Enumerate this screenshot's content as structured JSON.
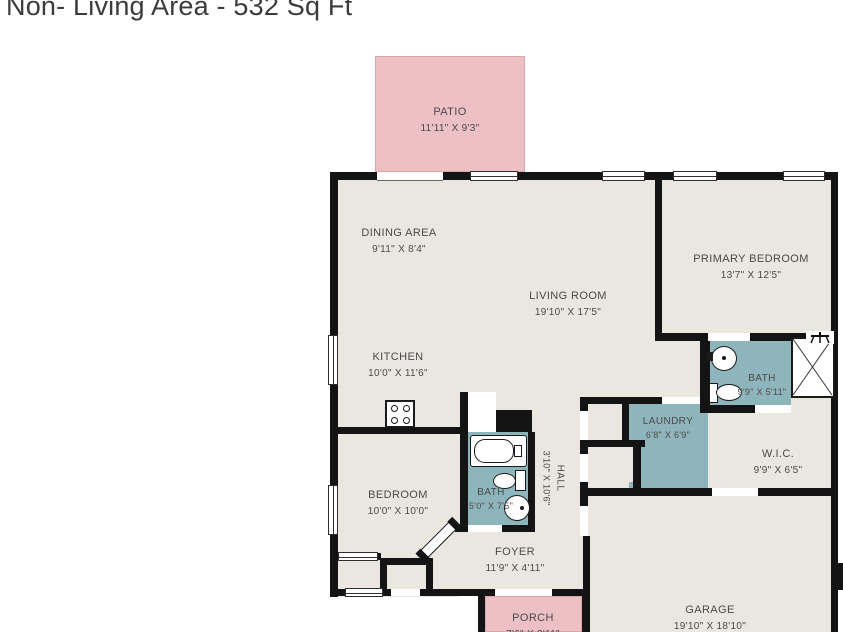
{
  "title": "Non- Living Area - 532 Sq Ft",
  "rooms": {
    "patio": {
      "name": "PATIO",
      "dims": "11'11\" X 9'3\""
    },
    "dining": {
      "name": "DINING AREA",
      "dims": "9'11\" X 8'4\""
    },
    "living": {
      "name": "LIVING ROOM",
      "dims": "19'10\" X 17'5\""
    },
    "primary_bedroom": {
      "name": "PRIMARY BEDROOM",
      "dims": "13'7\" X 12'5\""
    },
    "kitchen": {
      "name": "KITCHEN",
      "dims": "10'0\" X 11'6\""
    },
    "bath_main": {
      "name": "BATH",
      "dims": "5'0\" X 7'5\""
    },
    "hall": {
      "name": "HALL",
      "dims": "3'10\" X 10'6\""
    },
    "laundry": {
      "name": "LAUNDRY",
      "dims": "6'8\" X 6'9\""
    },
    "bath_primary": {
      "name": "BATH",
      "dims": "9'9\" X 5'11\""
    },
    "wic": {
      "name": "W.I.C.",
      "dims": "9'9\" X 6'5\""
    },
    "bedroom": {
      "name": "BEDROOM",
      "dims": "10'0\" X 10'0\""
    },
    "foyer": {
      "name": "FOYER",
      "dims": "11'9\" X 4'11\""
    },
    "porch": {
      "name": "PORCH",
      "dims": "7'6\" X 3'11\""
    },
    "garage": {
      "name": "GARAGE",
      "dims": "19'10\" X 18'10\""
    }
  },
  "colors": {
    "floor": "#eae7e1",
    "wall": "#141414",
    "wet_room": "#8fb5bc",
    "outdoor": "#edc0c4",
    "text": "#4a4a4a"
  }
}
